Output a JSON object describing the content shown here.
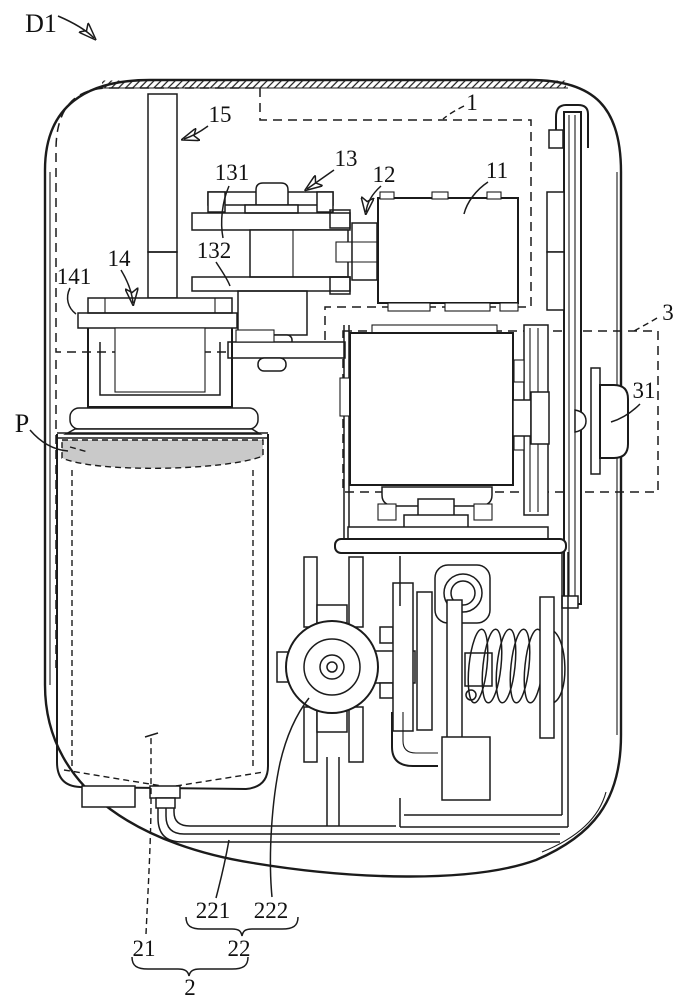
{
  "drawing": {
    "background": "#ffffff",
    "line_color": "#1b1b1b",
    "shade_color": "#c9c9c9",
    "style": "patent line drawing"
  },
  "callouts": {
    "device": "D1",
    "module_1": "1",
    "part_11": "11",
    "part_12": "12",
    "part_13": "13",
    "part_131": "131",
    "part_132": "132",
    "part_14": "14",
    "part_141": "141",
    "part_15": "15",
    "content_p": "P",
    "module_3": "3",
    "part_31": "31",
    "module_2": "2",
    "part_21": "21",
    "part_22": "22",
    "part_221": "221",
    "part_222": "222"
  }
}
